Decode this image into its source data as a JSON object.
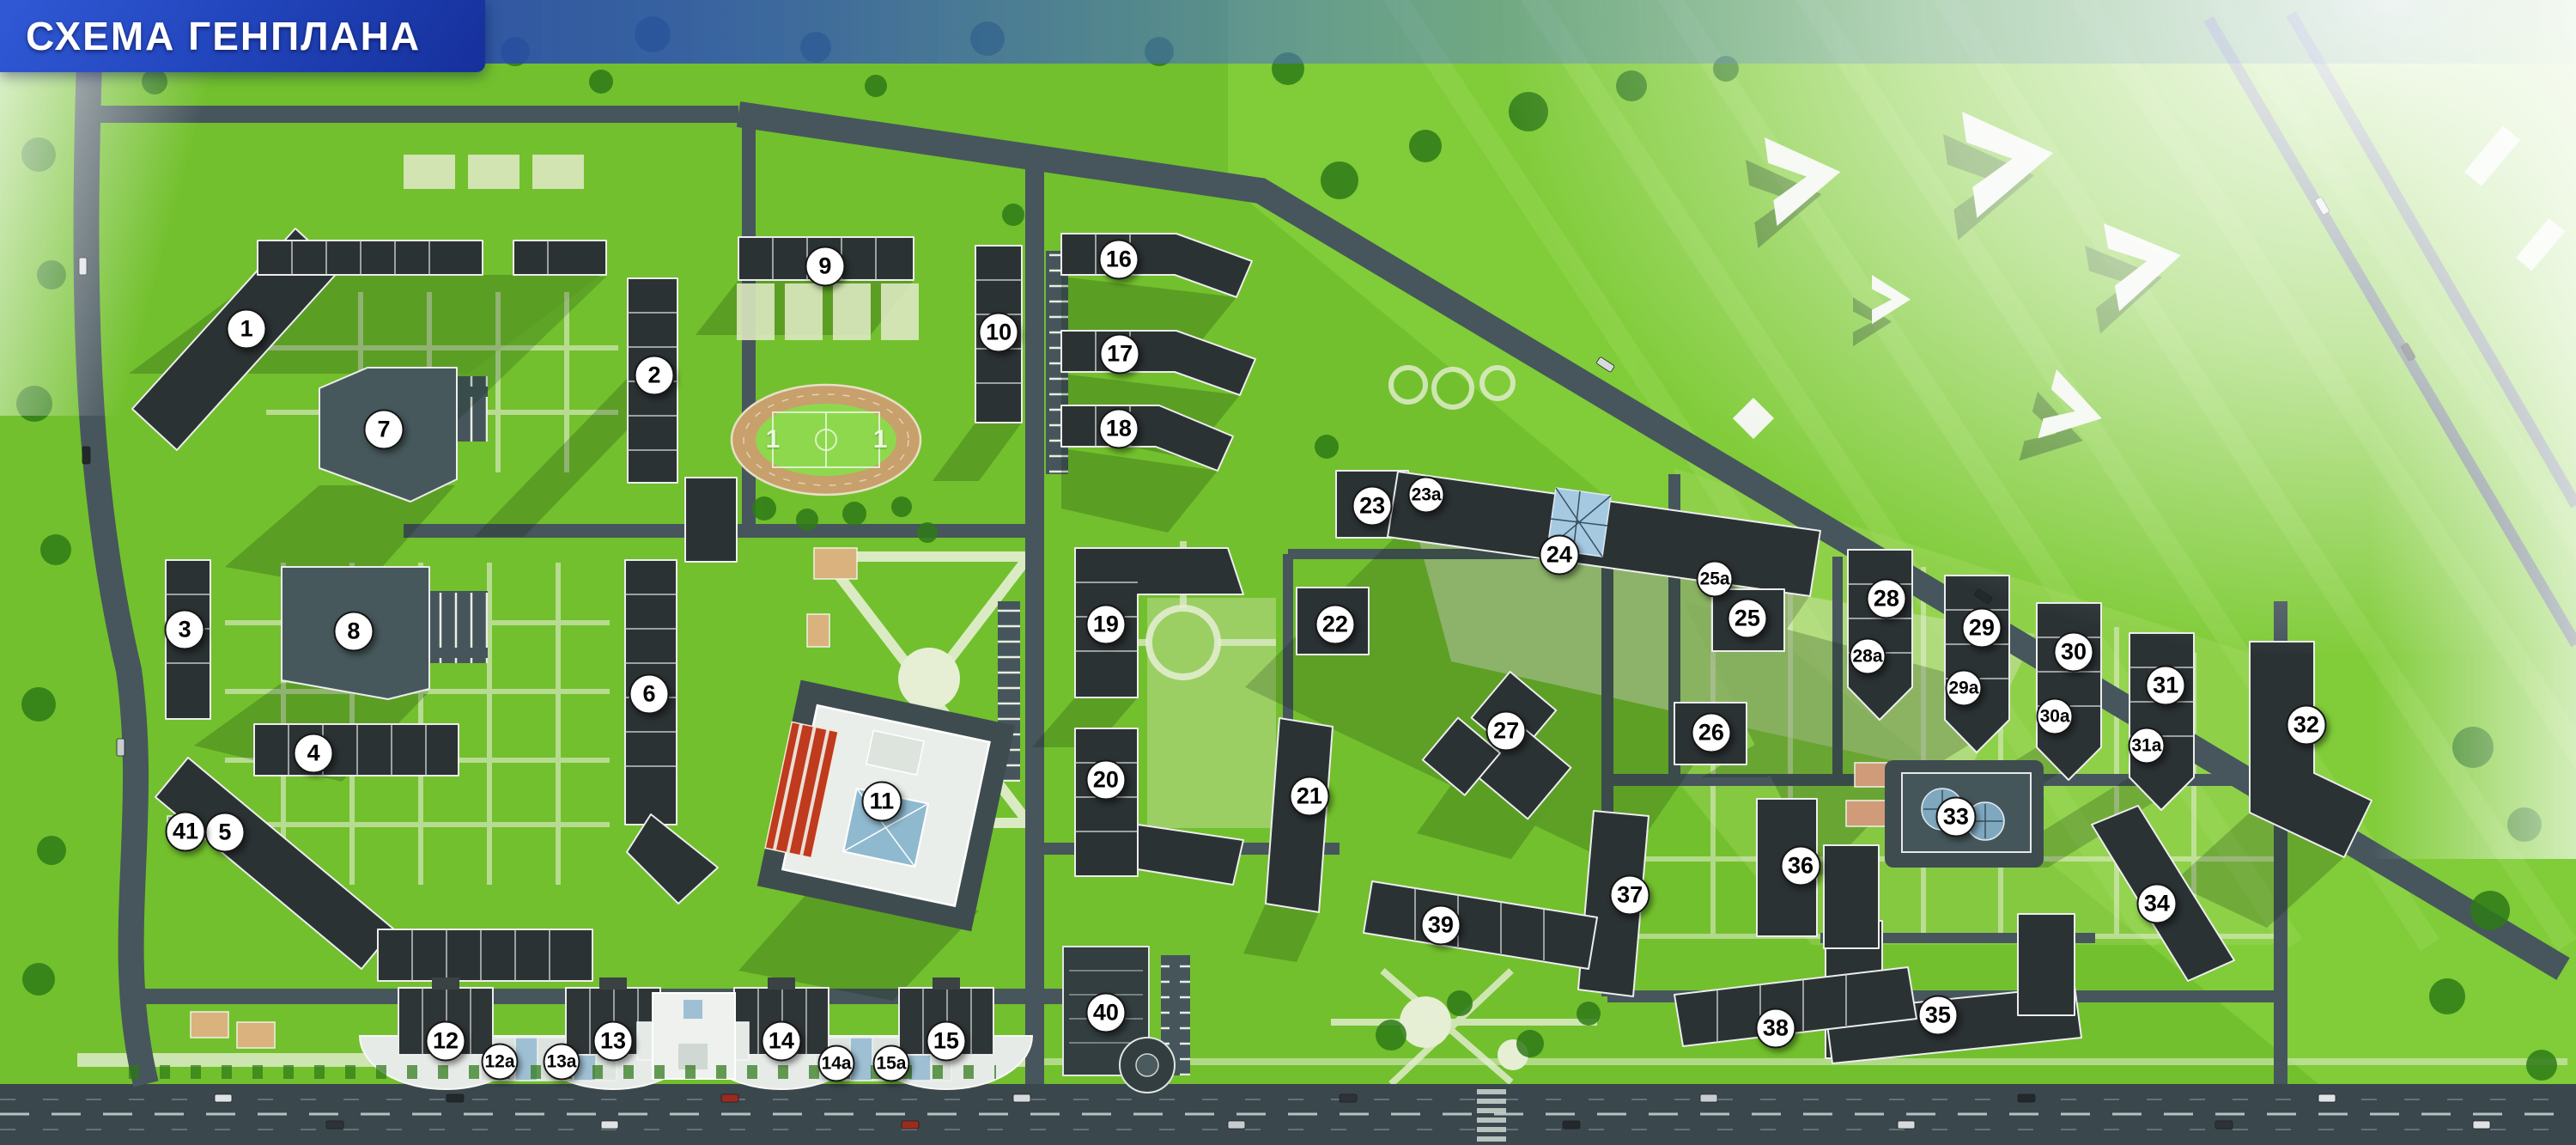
{
  "header": {
    "title": "СХЕМА ГЕНПЛАНА"
  },
  "colors": {
    "header_blue_dark": "#16309b",
    "header_blue_light": "#3159d6",
    "grass": "#72c02d",
    "grass_light": "#8ed84e",
    "path_light": "#e6efd4",
    "road": "#46565c",
    "boulevard": "#3a474d",
    "building_dark": "#2b3234",
    "building_slab": "#46585c",
    "building_white": "#eaeeea",
    "track_tan": "#c8a06c",
    "court_tan": "#d9b27e",
    "glass_blue": "#a6c9e2",
    "school_roof_red": "#c03a1e",
    "marker_bg": "#ffffff",
    "marker_border": "#161616",
    "marker_text": "#000000",
    "tree_green": "#2e7a18"
  },
  "markers": [
    {
      "label": "1",
      "x": 9.57,
      "y": 28.73
    },
    {
      "label": "2",
      "x": 25.4,
      "y": 32.78
    },
    {
      "label": "3",
      "x": 7.17,
      "y": 54.99
    },
    {
      "label": "4",
      "x": 12.17,
      "y": 65.79
    },
    {
      "label": "5",
      "x": 8.73,
      "y": 72.69
    },
    {
      "label": "6",
      "x": 25.2,
      "y": 60.62
    },
    {
      "label": "7",
      "x": 14.9,
      "y": 37.51
    },
    {
      "label": "8",
      "x": 13.73,
      "y": 55.14
    },
    {
      "label": "9",
      "x": 32.03,
      "y": 23.26
    },
    {
      "label": "10",
      "x": 38.77,
      "y": 29.03
    },
    {
      "label": "11",
      "x": 34.23,
      "y": 69.99
    },
    {
      "label": "12",
      "x": 17.3,
      "y": 90.92
    },
    {
      "label": "12а",
      "x": 19.4,
      "y": 92.72
    },
    {
      "label": "13а",
      "x": 21.8,
      "y": 92.72
    },
    {
      "label": "13",
      "x": 23.8,
      "y": 90.92
    },
    {
      "label": "14",
      "x": 30.33,
      "y": 90.92
    },
    {
      "label": "14а",
      "x": 32.47,
      "y": 92.87
    },
    {
      "label": "15а",
      "x": 34.6,
      "y": 92.87
    },
    {
      "label": "15",
      "x": 36.73,
      "y": 90.92
    },
    {
      "label": "16",
      "x": 43.43,
      "y": 22.66
    },
    {
      "label": "17",
      "x": 43.47,
      "y": 30.91
    },
    {
      "label": "18",
      "x": 43.43,
      "y": 37.43
    },
    {
      "label": "19",
      "x": 42.93,
      "y": 54.54
    },
    {
      "label": "20",
      "x": 42.93,
      "y": 68.12
    },
    {
      "label": "21",
      "x": 50.83,
      "y": 69.54
    },
    {
      "label": "22",
      "x": 51.83,
      "y": 54.54
    },
    {
      "label": "23",
      "x": 53.27,
      "y": 44.19
    },
    {
      "label": "23а",
      "x": 55.37,
      "y": 43.21
    },
    {
      "label": "24",
      "x": 60.53,
      "y": 48.46
    },
    {
      "label": "25а",
      "x": 66.57,
      "y": 50.56
    },
    {
      "label": "25",
      "x": 67.83,
      "y": 54.01
    },
    {
      "label": "26",
      "x": 66.43,
      "y": 63.99
    },
    {
      "label": "27",
      "x": 58.47,
      "y": 63.84
    },
    {
      "label": "28",
      "x": 73.23,
      "y": 52.29
    },
    {
      "label": "28а",
      "x": 72.5,
      "y": 57.31
    },
    {
      "label": "29",
      "x": 76.93,
      "y": 54.84
    },
    {
      "label": "29а",
      "x": 76.23,
      "y": 60.09
    },
    {
      "label": "30",
      "x": 80.5,
      "y": 56.94
    },
    {
      "label": "30а",
      "x": 79.77,
      "y": 62.57
    },
    {
      "label": "31",
      "x": 84.07,
      "y": 59.86
    },
    {
      "label": "31а",
      "x": 83.33,
      "y": 65.12
    },
    {
      "label": "32",
      "x": 89.53,
      "y": 63.32
    },
    {
      "label": "33",
      "x": 75.93,
      "y": 71.34
    },
    {
      "label": "34",
      "x": 83.73,
      "y": 78.92
    },
    {
      "label": "35",
      "x": 75.23,
      "y": 88.67
    },
    {
      "label": "36",
      "x": 69.9,
      "y": 75.62
    },
    {
      "label": "37",
      "x": 63.27,
      "y": 78.17
    },
    {
      "label": "38",
      "x": 68.93,
      "y": 89.8
    },
    {
      "label": "39",
      "x": 55.93,
      "y": 80.8
    },
    {
      "label": "40",
      "x": 42.93,
      "y": 88.45
    },
    {
      "label": "41",
      "x": 7.2,
      "y": 72.62
    }
  ],
  "field_marks": [
    {
      "label": "1",
      "x": 30.0,
      "y": 38.41
    },
    {
      "label": "1",
      "x": 34.17,
      "y": 38.41
    }
  ]
}
